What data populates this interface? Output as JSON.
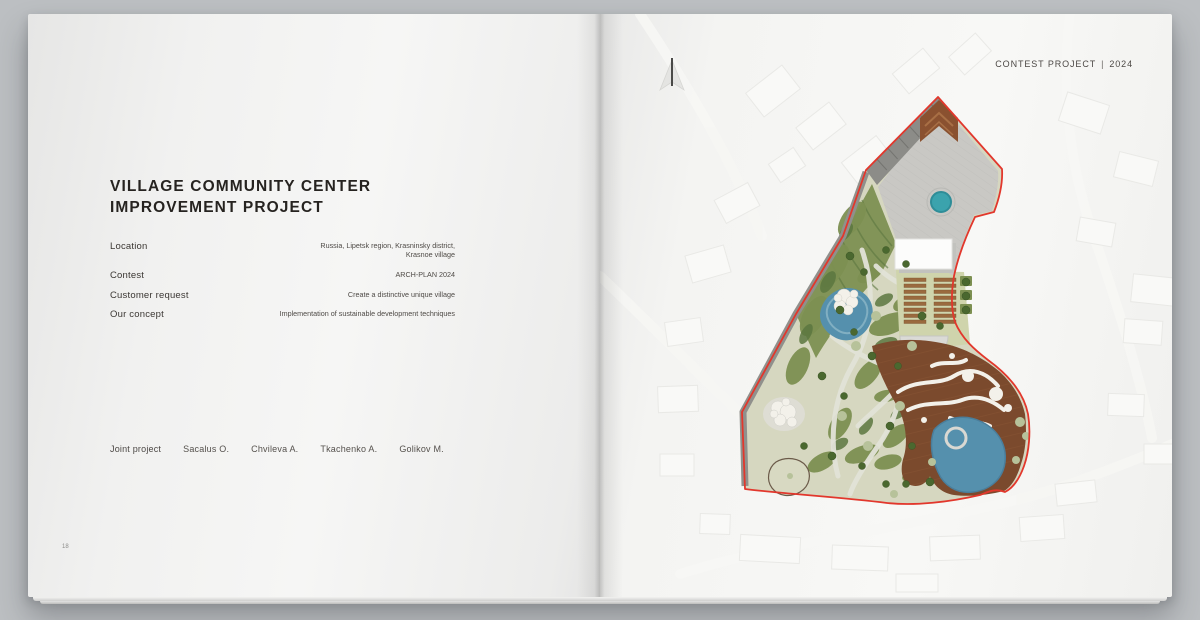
{
  "left_page": {
    "page_number": "18",
    "title_line1": "VILLAGE COMMUNITY CENTER",
    "title_line2": "IMPROVEMENT PROJECT",
    "details": [
      {
        "label": "Location",
        "value": "Russia, Lipetsk region, Krasninsky district,\nKrasnoe village"
      },
      {
        "label": "Contest",
        "value": "ARCH-PLAN 2024"
      },
      {
        "label": "Customer request",
        "value": "Create a distinctive unique village"
      },
      {
        "label": "Our concept",
        "value": "Implementation of sustainable development techniques"
      }
    ],
    "team_label": "Joint project",
    "team_members": [
      "Sacalus O.",
      "Chvileva A.",
      "Tkachenko A.",
      "Golikov M."
    ]
  },
  "right_page": {
    "header_label": "CONTEST PROJECT",
    "header_divider": "|",
    "header_year": "2024",
    "plan": {
      "palette": {
        "boundary_red": "#e2372c",
        "plaza_gray": "#c9c8c4",
        "stairs_gray": "#8c8c88",
        "road_gray": "#90908c",
        "chevron_brown": "#8a5130",
        "chevron_light": "#a86f45",
        "deck_brown": "#7b4a2d",
        "deck_stripe": "#8a5636",
        "beds_brown": "#9a6a3e",
        "pond_teal": "#3ba3ad",
        "pond_teal_dark": "#2e8d98",
        "water_blue": "#5590ad",
        "water_light": "#8ab5c5",
        "park_base": "#d6d7c0",
        "green_dark": "#5c7740",
        "green_mid": "#7d9052",
        "green_light": "#cfd4ac",
        "path_light": "#e2e3d8",
        "tree_dark": "#4a682f",
        "tree_light": "#b7c29a",
        "white_soft": "#f3f1ea",
        "building_white": "#fcfcfb",
        "dome_gray": "#dadad6",
        "context_fill": "#f9f9f7"
      }
    }
  }
}
